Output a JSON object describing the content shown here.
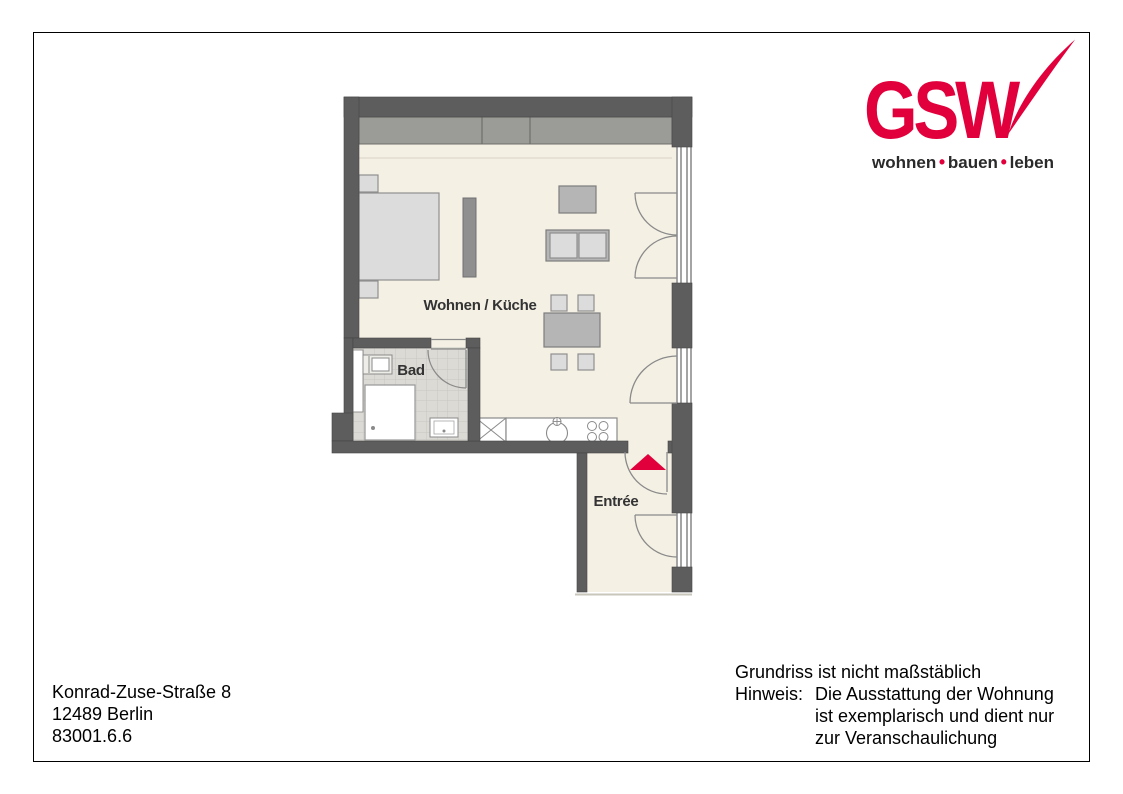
{
  "logo": {
    "name": "GSW",
    "tagline_words": [
      "wohnen",
      "bauen",
      "leben"
    ],
    "tagline_separator": "•",
    "brand_red": "#e1003c",
    "tagline_color": "#2a2a2a"
  },
  "floorplan": {
    "room_labels": {
      "living_kitchen": "Wohnen / Küche",
      "bath": "Bad",
      "entry": "Entrée"
    },
    "entrance_marker": "red-triangle",
    "colors": {
      "wall": "#5d5d5d",
      "floor": "#f4f0e4",
      "tile": "#dcdad5",
      "tile_grid": "#c8c6c0",
      "furniture_light": "#dcdcdc",
      "furniture_medium": "#b5b5b5",
      "furniture_dark": "#8f8f8f",
      "wardrobe": "#9b9b97",
      "door_swing": "#8a8a8a",
      "accent_red": "#e1003c"
    }
  },
  "address": {
    "lines": [
      "Konrad-Zuse-Straße 8",
      "12489 Berlin",
      "83001.6.6"
    ]
  },
  "disclaimer": {
    "line1": "Grundriss ist nicht maßstäblich",
    "hinweis_label": "Hinweis:",
    "hinweis_lines": [
      "Die Ausstattung der Wohnung",
      "ist exemplarisch und dient nur",
      "zur Veranschaulichung"
    ]
  }
}
